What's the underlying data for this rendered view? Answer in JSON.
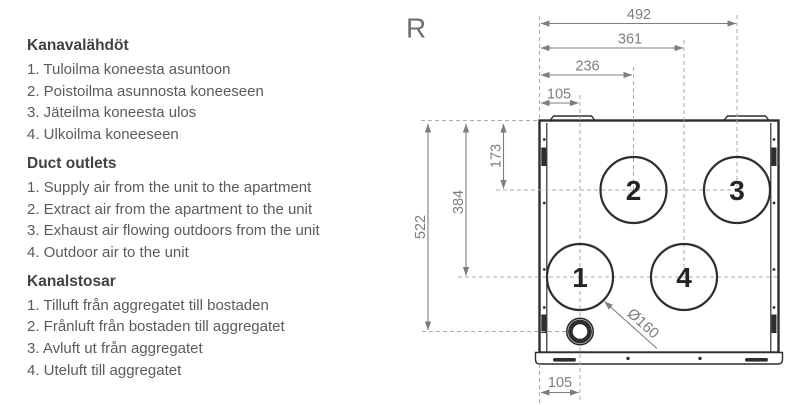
{
  "legend": {
    "sections": [
      {
        "heading": "Kanavalähdöt",
        "items": [
          "1. Tuloilma koneesta asuntoon",
          "2. Poistoilma asunnosta koneeseen",
          "3. Jäteilma koneesta ulos",
          "4. Ulkoilma koneeseen"
        ]
      },
      {
        "heading": "Duct outlets",
        "items": [
          "1. Supply air from the unit to the apartment",
          "2. Extract air from the apartment to the unit",
          "3. Exhaust air flowing outdoors from the unit",
          "4. Outdoor air to the unit"
        ]
      },
      {
        "heading": "Kanalstosar",
        "items": [
          "1. Tilluft från aggregatet till bostaden",
          "2. Frånluft från bostaden till aggregatet",
          "3. Avluft ut från aggregatet",
          "4. Uteluft till aggregatet"
        ]
      }
    ]
  },
  "drawing": {
    "view_label": "R",
    "dims_top": [
      "492",
      "361",
      "236",
      "105"
    ],
    "dims_left": [
      "522",
      "384",
      "173"
    ],
    "dim_bottom": "105",
    "diameter_label": "Ø160",
    "ports": [
      "1",
      "2",
      "3",
      "4"
    ],
    "colors": {
      "drawing_line": "#2e2e30",
      "dimension": "#7d7e81",
      "dashed": "#a9abae",
      "body_text": "#5a5b5e",
      "heading_text": "#424246"
    }
  }
}
